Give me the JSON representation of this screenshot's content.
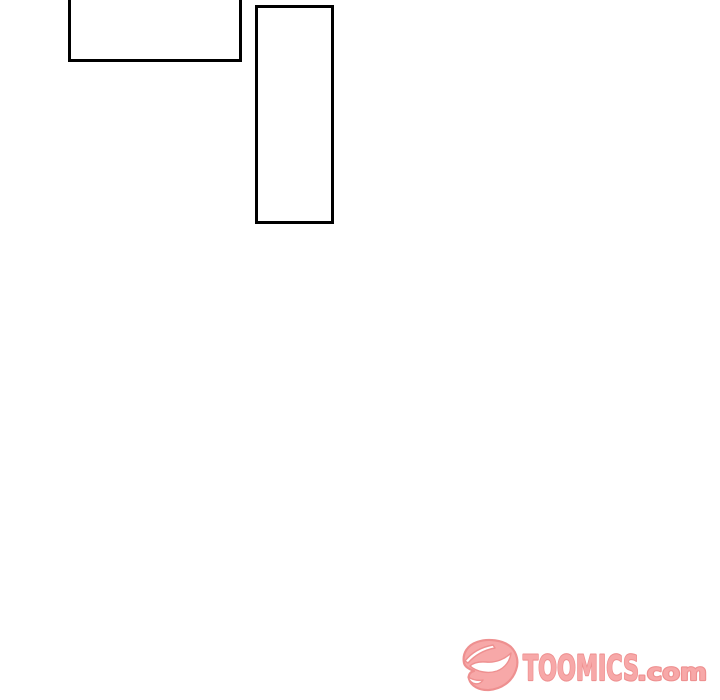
{
  "page": {
    "background_color": "#ffffff",
    "panel_border_color": "#000000"
  },
  "panels": {
    "count": 2,
    "content": ""
  },
  "watermark": {
    "brand_text": "TOOMICS",
    "suffix_text": ".com",
    "icon": "toomics-mask-icon",
    "fill_color": "#f7a8a8",
    "outline_color": "#ee9090"
  }
}
